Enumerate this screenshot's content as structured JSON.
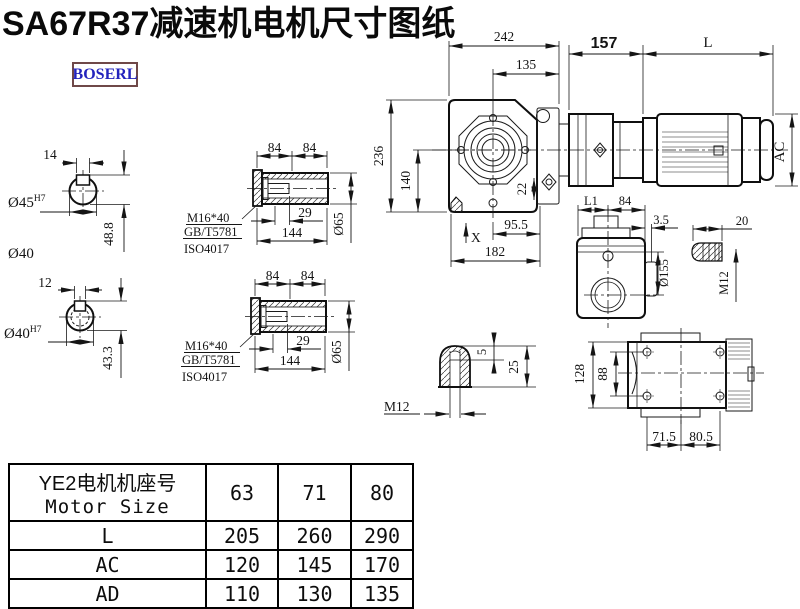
{
  "page": {
    "title": "SA67R37减速机电机尺寸图纸",
    "brand": "BOSERL"
  },
  "colors": {
    "brand_text": "#2323bd",
    "brand_border": "#6f4848",
    "line": "#141414",
    "background": "#ffffff"
  },
  "shaft_section_top": {
    "keyway_width": "14",
    "bore": "Ø45",
    "bore_tolerance": "H7",
    "keyway_height": "48.8",
    "shaft_label": "Ø40"
  },
  "shaft_section_bottom": {
    "keyway_width": "12",
    "bore": "Ø40",
    "bore_tolerance": "H7",
    "keyway_height": "43.3"
  },
  "hollow_shaft": {
    "dim_84_left": "84",
    "dim_84_right": "84",
    "bolt_depth": "29",
    "length": "144",
    "outer_dia": "Ø65",
    "bolt_spec": "M16*40",
    "standard_1": "GB/T5781",
    "standard_2": "ISO4017"
  },
  "main_view": {
    "overall_width": "242",
    "center_to_face": "135",
    "adapter_length": "157",
    "motor_length": "L",
    "overall_height": "236",
    "center_height": "140",
    "foot_dim": "22",
    "center_to_flange": "95.5",
    "base_width": "182",
    "marker_x": "X",
    "motor_dia": "AC"
  },
  "side_view": {
    "dim_l1": "L1",
    "dim_84": "84",
    "dim_3_5": "3.5",
    "flange_dia": "Ø155",
    "dim_20": "20",
    "thread": "M12"
  },
  "plug_detail": {
    "dim_5": "5",
    "dim_25": "25",
    "thread": "M12"
  },
  "top_view": {
    "height": "128",
    "bolt_spacing": "88",
    "dim_71_5": "71.5",
    "dim_80_5": "80.5"
  },
  "size_table": {
    "header_cn": "YE2电机机座号",
    "header_en": "Motor Size",
    "sizes": [
      "63",
      "71",
      "80"
    ],
    "rows": [
      {
        "label": "L",
        "values": [
          "205",
          "260",
          "290"
        ]
      },
      {
        "label": "AC",
        "values": [
          "120",
          "145",
          "170"
        ]
      },
      {
        "label": "AD",
        "values": [
          "110",
          "130",
          "135"
        ]
      }
    ]
  }
}
